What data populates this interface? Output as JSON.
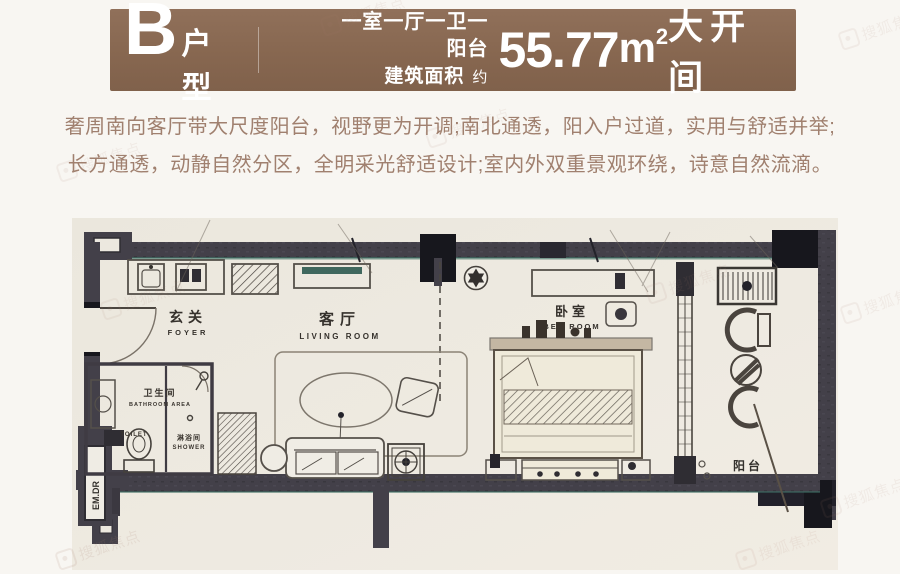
{
  "header": {
    "unit_letter": "B",
    "unit_label": "户型",
    "layout_line": "一室一厅一卫一阳台",
    "area_prefix": "建筑面积",
    "area_approx": "约",
    "area_value": "55.77",
    "area_unit": "m",
    "area_sup": "2",
    "tag": "大开间",
    "banner_color": "#876750"
  },
  "description": {
    "lines": [
      "奢周南向客厅带大尺度阳台，视野更为开调;南北通透，阳入户过道，实用与舒适并举;",
      "长方通透，动静自然分区，全明采光舒适设计;室内外双重景观环绕，诗意自然流滴。"
    ],
    "text_color": "#a0806f"
  },
  "floorplan": {
    "paper_color": "#edeae1",
    "wall_color": "#434049",
    "accent_teal": "#3c6e63",
    "rooms": {
      "foyer_cn": "玄关",
      "foyer_en": "FOYER",
      "living_cn": "客厅",
      "living_en": "LIVING ROOM",
      "bedroom_cn": "卧室",
      "bedroom_en": "BED ROOM",
      "bathroom_cn": "卫生间",
      "bathroom_en": "BATHROOM AREA",
      "toilet_en": "TOILET",
      "shower_cn": "淋浴间",
      "shower_en": "SHOWER",
      "balcony_cn": "阳台",
      "exit_label": "EM.DR"
    }
  },
  "watermark": {
    "text": "搜狐焦点"
  }
}
